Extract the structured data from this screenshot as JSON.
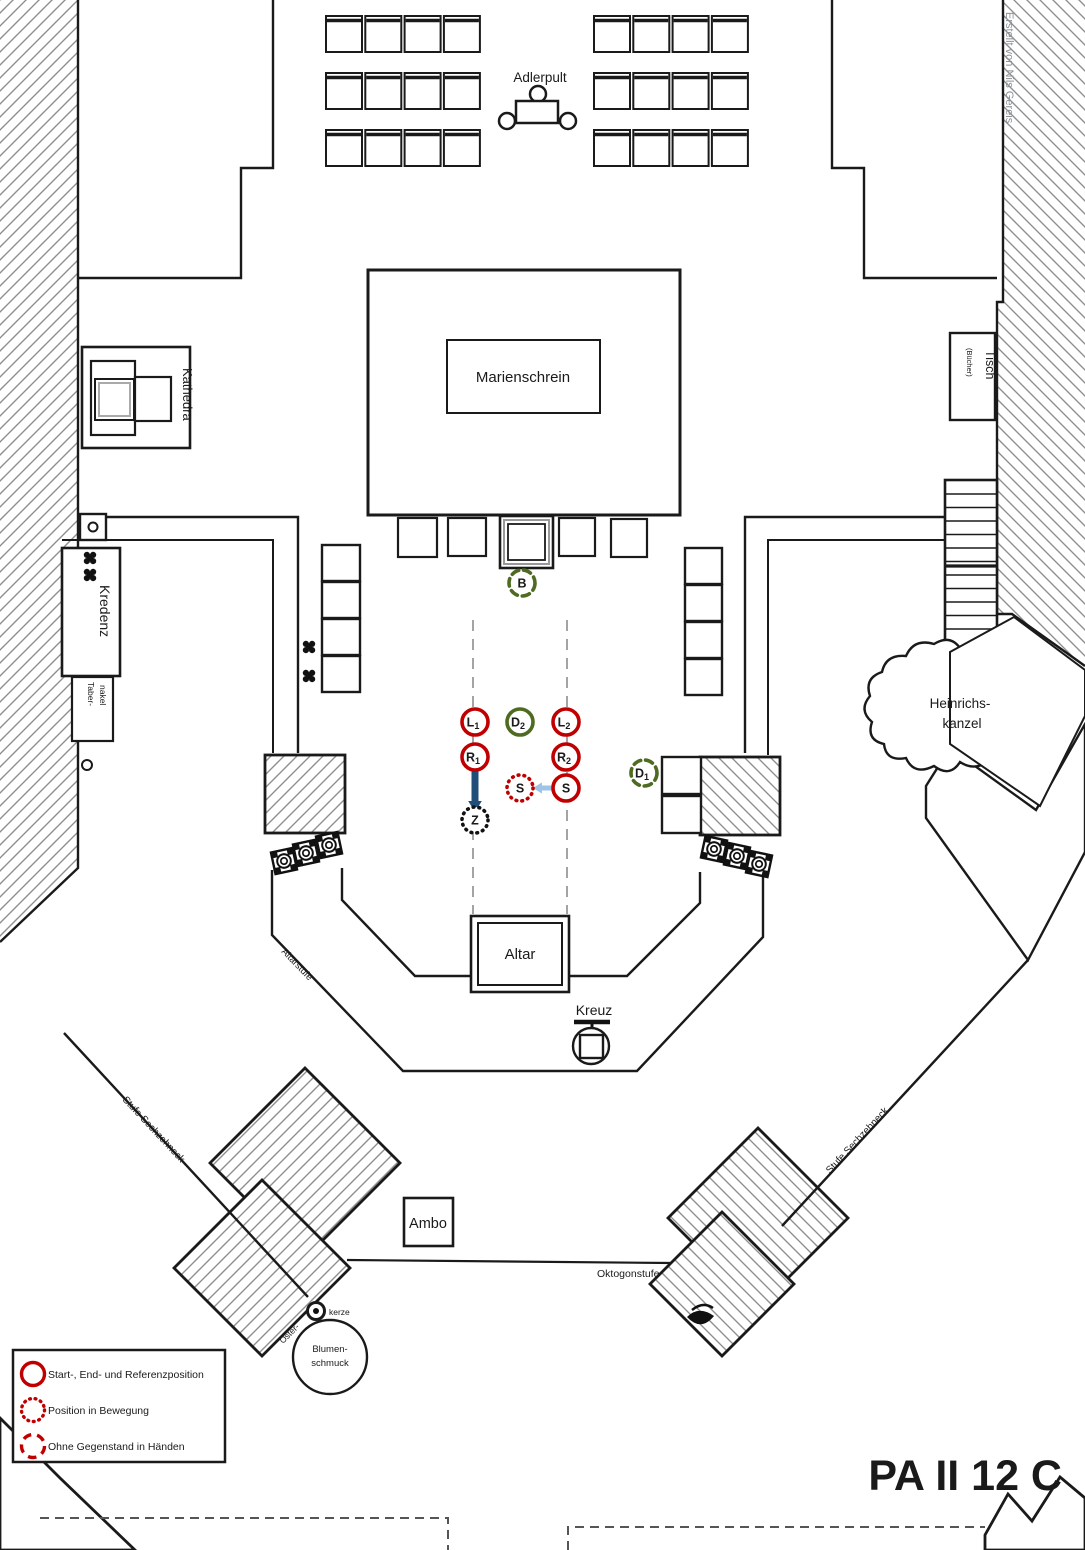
{
  "title": "PA II 12 C",
  "credit": "Erstellt von Nils Gereis",
  "plan_labels": {
    "adlerpult": "Adlerpult",
    "marienschrein": "Marienschrein",
    "kathedra": "Kathedra",
    "tisch": "Tisch",
    "tisch_sub": "(Bücher)",
    "kredenz": "Kredenz",
    "tabernakel_line1": "Taber-",
    "tabernakel_line2": "nakel",
    "heinrichskanzel_line1": "Heinrichs-",
    "heinrichskanzel_line2": "kanzel",
    "altar": "Altar",
    "kreuz": "Kreuz",
    "altarstufe": "Altarstufe",
    "ambo": "Ambo",
    "oktogonstufe": "Oktogonstufe",
    "stufe_sechzehneck_left": "Stufe Sechzehneck",
    "stufe_sechzehneck_right": "Stufe Sechzehneck",
    "osterkerze_line1": "Oster-",
    "osterkerze_line2": "kerze",
    "blumenschmuck_line1": "Blumen-",
    "blumenschmuck_line2": "schmuck"
  },
  "legend": {
    "items": [
      {
        "style": "solid",
        "label": "Start-, End- und Referenzposition"
      },
      {
        "style": "dotted",
        "label": "Position in Bewegung"
      },
      {
        "style": "dashed",
        "label": "Ohne Gegenstand in Händen"
      }
    ]
  },
  "markers": [
    {
      "id": "B",
      "label": "B",
      "sub": "",
      "x": 522,
      "y": 583,
      "stroke": "green",
      "line": "dashed"
    },
    {
      "id": "L1",
      "label": "L",
      "sub": "1",
      "x": 475,
      "y": 722,
      "stroke": "red",
      "line": "solid"
    },
    {
      "id": "D2",
      "label": "D",
      "sub": "2",
      "x": 520,
      "y": 722,
      "stroke": "green",
      "line": "solid"
    },
    {
      "id": "L2",
      "label": "L",
      "sub": "2",
      "x": 566,
      "y": 722,
      "stroke": "red",
      "line": "solid"
    },
    {
      "id": "R1",
      "label": "R",
      "sub": "1",
      "x": 475,
      "y": 757,
      "stroke": "red",
      "line": "solid"
    },
    {
      "id": "R2",
      "label": "R",
      "sub": "2",
      "x": 566,
      "y": 757,
      "stroke": "red",
      "line": "solid"
    },
    {
      "id": "S-moving",
      "label": "S",
      "sub": "",
      "x": 520,
      "y": 788,
      "stroke": "red",
      "line": "dotted"
    },
    {
      "id": "S",
      "label": "S",
      "sub": "",
      "x": 566,
      "y": 788,
      "stroke": "red",
      "line": "solid"
    },
    {
      "id": "D1",
      "label": "D",
      "sub": "1",
      "x": 644,
      "y": 773,
      "stroke": "green",
      "line": "dashed"
    },
    {
      "id": "Z",
      "label": "Z",
      "sub": "",
      "x": 475,
      "y": 820,
      "stroke": "black",
      "line": "dotted"
    }
  ],
  "arrows": [
    {
      "name": "movement-arrow-down",
      "color": "#1f4e79",
      "width": 7,
      "head": 11,
      "from": [
        475,
        770
      ],
      "to": [
        475,
        812
      ]
    },
    {
      "name": "movement-arrow-left",
      "color": "#9dc3e6",
      "width": 5,
      "head": 9,
      "from": [
        555,
        788
      ],
      "to": [
        533,
        788
      ]
    }
  ],
  "colors": {
    "red": "#c00000",
    "green": "#4e6b21",
    "black": "#111111",
    "hatch": "#8f8f8f"
  }
}
